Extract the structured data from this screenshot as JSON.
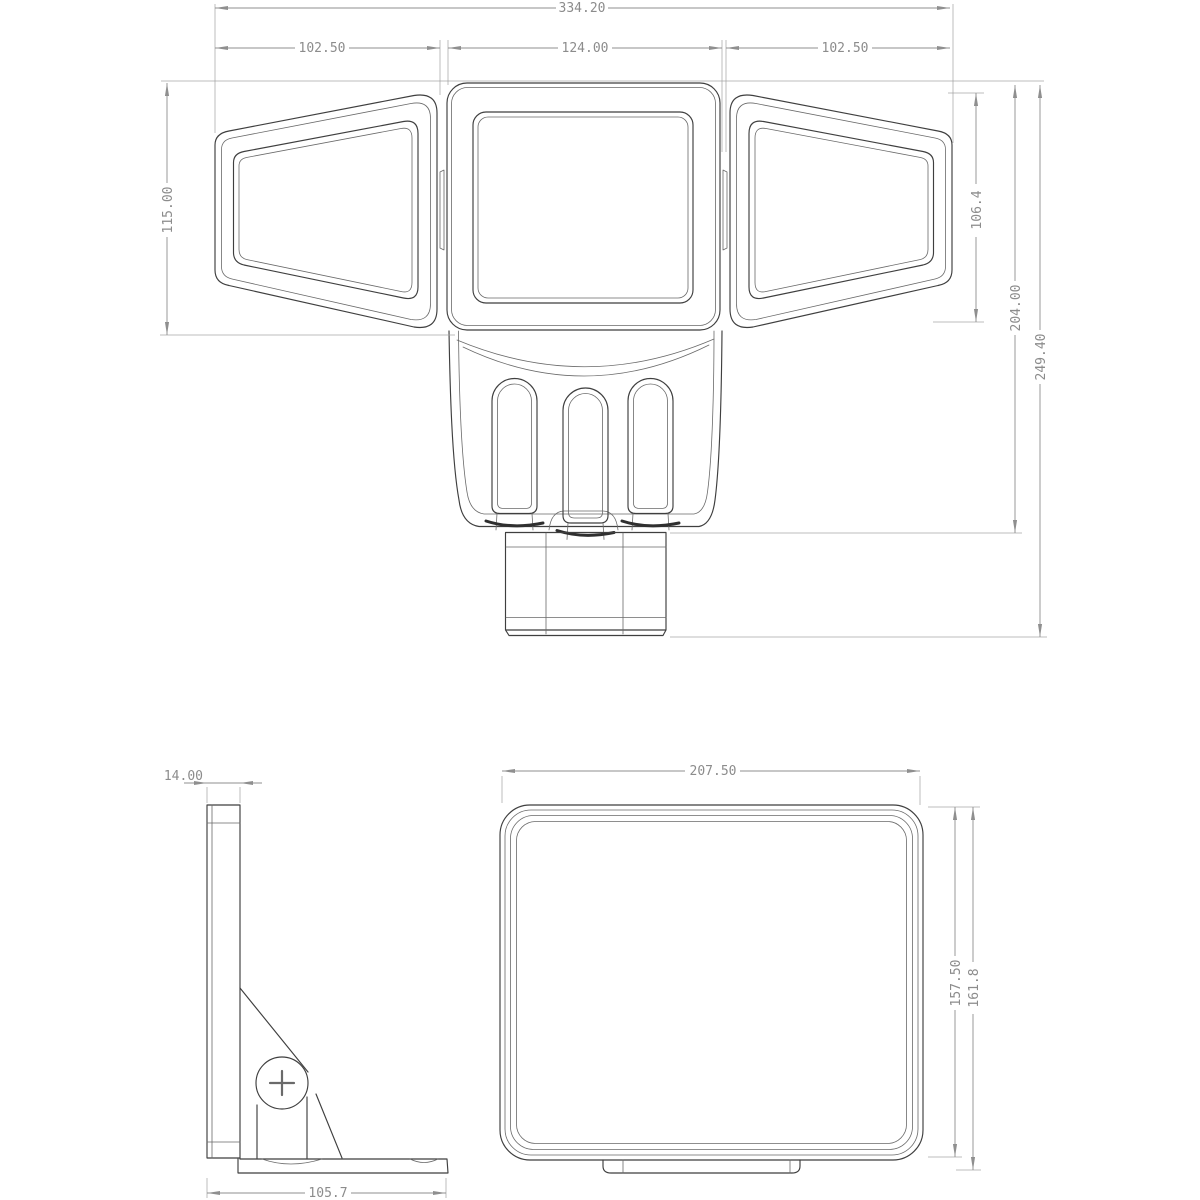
{
  "colors": {
    "background": "#ffffff",
    "object_line": "#3f3f3f",
    "dimension_line": "#8f8f8f",
    "dimension_text": "#8c8c8c"
  },
  "front_view": {
    "overall_width": "334.20",
    "left_panel_width": "102.50",
    "center_panel_width": "124.00",
    "right_panel_width": "102.50",
    "head_height": "115.00",
    "side_panel_height": "106.4",
    "body_height": "204.00",
    "overall_height": "249.40"
  },
  "side_view": {
    "panel_thickness": "14.00",
    "base_depth": "105.7"
  },
  "back_view": {
    "width": "207.50",
    "height": "157.50",
    "overall_height": "161.8"
  }
}
